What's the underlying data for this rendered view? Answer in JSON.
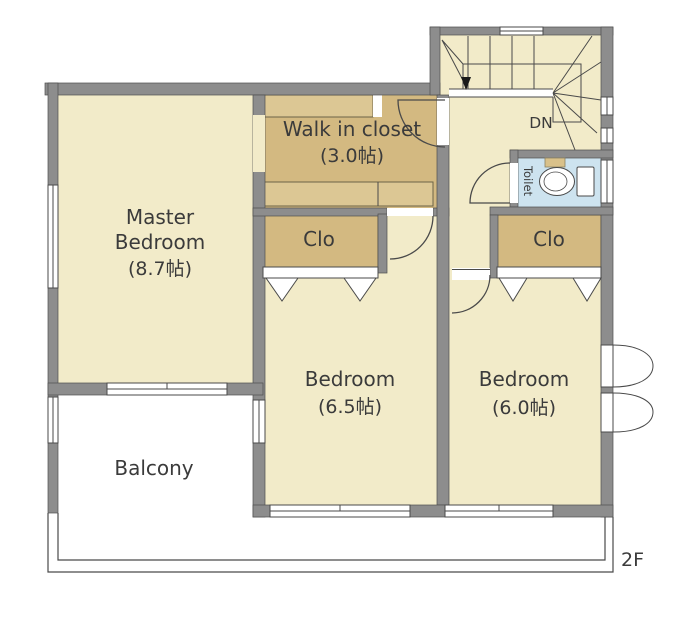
{
  "floor_label": "2F",
  "rooms": {
    "master_bedroom": {
      "name_line1": "Master",
      "name_line2": "Bedroom",
      "size": "(8.7帖)"
    },
    "walk_in_closet": {
      "name": "Walk in closet",
      "size": "(3.0帖)"
    },
    "bedroom_center": {
      "name": "Bedroom",
      "size": "(6.5帖)"
    },
    "bedroom_right": {
      "name": "Bedroom",
      "size": "(6.0帖)"
    },
    "balcony": {
      "name": "Balcony"
    },
    "toilet": {
      "name": "Toilet"
    },
    "closet_left": {
      "label": "Clo"
    },
    "closet_right": {
      "label": "Clo"
    }
  },
  "stairs": {
    "down_label": "DN"
  },
  "colors": {
    "wall": "#8d8d8d",
    "wall_edge": "#4f4f4f",
    "floor_cream": "#f2ebc9",
    "floor_tan": "#d3b981",
    "hanger_strip": "#dcc794",
    "toilet_floor": "#cde3ef",
    "line": "#4a4a4a",
    "text": "#3b3b3b",
    "background": "#ffffff"
  }
}
